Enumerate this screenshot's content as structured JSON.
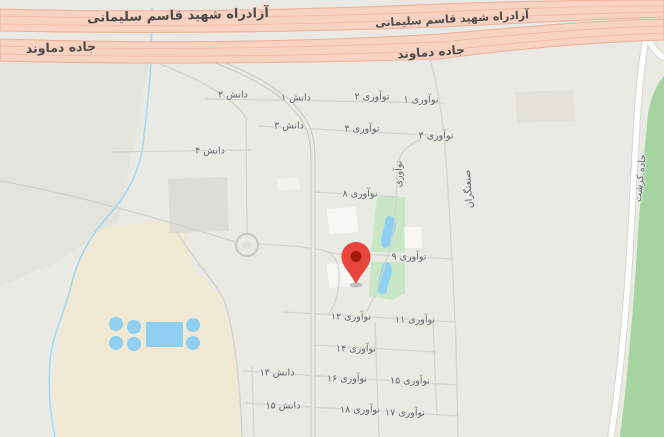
{
  "map": {
    "palette": {
      "background": "#E9EAE4",
      "left_block": "#E3E4DE",
      "highway_fill": "#F8D3C1",
      "highway_stroke": "#EFAD97",
      "road_gray": "#D2D4CD",
      "road_white": "#FFFFFF",
      "road_casing": "#D6D8D1",
      "stream_blue": "#A9D7F0",
      "water_blue": "#8FD0F2",
      "park_green": "#C9E7C6",
      "roadside_green": "#A5D4A1",
      "sand_beige": "#EFE8D2",
      "building_gray": "#DCDDD7",
      "label_gray": "#5C6065"
    },
    "marker": {
      "name": "location-pin",
      "color": "#E8453C",
      "inner_color": "#A31B0D",
      "x": 356,
      "y": 256
    },
    "highway_labels": [
      {
        "text": "آزادراه شهید قاسم سلیمانی",
        "x": 178,
        "y": 16,
        "rot": -1.5,
        "size": 13,
        "cls": "hw"
      },
      {
        "text": "آزادراه شهید قاسم سلیمانی",
        "x": 452,
        "y": 19,
        "rot": -3,
        "size": 11,
        "cls": "hw"
      },
      {
        "text": "جاده دماوند",
        "x": 61,
        "y": 48,
        "rot": -2,
        "size": 12.5,
        "cls": "hw"
      },
      {
        "text": "جاده دماوند",
        "x": 431,
        "y": 52,
        "rot": -4,
        "size": 12,
        "cls": "hw"
      }
    ],
    "street_labels": [
      {
        "text": "دانش ۲",
        "x": 233,
        "y": 95,
        "cls": "st"
      },
      {
        "text": "دانش ۱",
        "x": 296,
        "y": 98,
        "cls": "st"
      },
      {
        "text": "نوآوری ۲",
        "x": 372,
        "y": 97,
        "cls": "st"
      },
      {
        "text": "نوآوری ۱",
        "x": 421,
        "y": 100,
        "cls": "st"
      },
      {
        "text": "دانش ۳",
        "x": 289,
        "y": 126,
        "cls": "st"
      },
      {
        "text": "نوآوری ۴",
        "x": 362,
        "y": 129,
        "cls": "st"
      },
      {
        "text": "نوآوری ۳",
        "x": 436,
        "y": 136,
        "cls": "st"
      },
      {
        "text": "دانش ۴",
        "x": 210,
        "y": 151,
        "cls": "st"
      },
      {
        "text": "نوآوری",
        "x": 399,
        "y": 174,
        "rot": -90,
        "cls": "st"
      },
      {
        "text": "صنعتگران",
        "x": 469,
        "y": 189,
        "rot": -94,
        "cls": "st"
      },
      {
        "text": "نوآوری ۸",
        "x": 360,
        "y": 194,
        "cls": "st"
      },
      {
        "text": "نوآوری ۹",
        "x": 409,
        "y": 257,
        "cls": "st"
      },
      {
        "text": "نوآوری ۱۲",
        "x": 351,
        "y": 317,
        "cls": "st"
      },
      {
        "text": "نوآوری ۱۱",
        "x": 415,
        "y": 320,
        "cls": "st"
      },
      {
        "text": "نوآوری ۱۴",
        "x": 356,
        "y": 349,
        "cls": "st"
      },
      {
        "text": "دانش ۱۳",
        "x": 277,
        "y": 373,
        "cls": "st"
      },
      {
        "text": "نوآوری ۱۶",
        "x": 347,
        "y": 379,
        "cls": "st"
      },
      {
        "text": "نوآوری ۱۵",
        "x": 410,
        "y": 381,
        "cls": "st"
      },
      {
        "text": "دانش ۱۵",
        "x": 283,
        "y": 406,
        "cls": "st"
      },
      {
        "text": "نوآوری ۱۸",
        "x": 360,
        "y": 410,
        "cls": "st"
      },
      {
        "text": "نوآوری ۱۷",
        "x": 405,
        "y": 413,
        "cls": "st"
      },
      {
        "text": "جاده کرشت",
        "x": 641,
        "y": 178,
        "rot": -84,
        "cls": "st"
      }
    ]
  }
}
